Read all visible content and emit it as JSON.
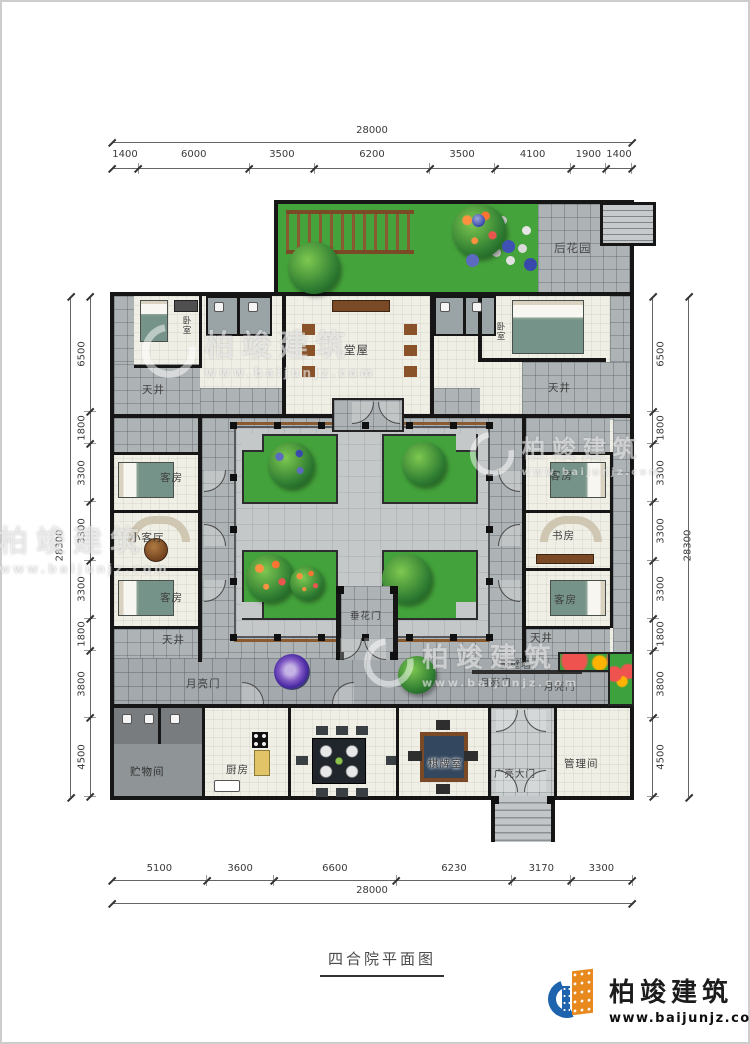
{
  "title_block": {
    "title": "四合院平面图"
  },
  "dimensions": {
    "top": {
      "total": "28000",
      "segments": [
        "1400",
        "6000",
        "3500",
        "6200",
        "3500",
        "4100",
        "1900",
        "1400"
      ]
    },
    "bottom": {
      "total": "28000",
      "segments": [
        "5100",
        "3600",
        "6600",
        "6230",
        "3170",
        "3300"
      ]
    },
    "left": {
      "total": "28300",
      "segments": [
        "6500",
        "1800",
        "3300",
        "3300",
        "3300",
        "1800",
        "3800",
        "4500"
      ]
    },
    "right": {
      "total": "28300",
      "segments": [
        "6500",
        "1800",
        "3300",
        "3300",
        "3300",
        "1800",
        "3800",
        "4500"
      ]
    }
  },
  "rooms": {
    "back_garden": "后花园",
    "hall": "堂屋",
    "bedroom": "卧室",
    "skywell": "天井",
    "guest_room": "客房",
    "small_living_room": "小客厅",
    "study": "书房",
    "festoon_gate": "垂花门",
    "moon_gate": "月亮门",
    "screen_wall": "影壁墙",
    "storage_room": "贮物间",
    "kitchen": "厨房",
    "chess_room": "棋牌室",
    "grand_gate": "广亮大门",
    "manager_room": "管理间"
  },
  "watermark": {
    "brand": "柏竣建筑",
    "url": "www.baijunjz.com"
  },
  "logo": {
    "brand": "柏竣建筑",
    "url": "www.baijunjz.com"
  },
  "colors": {
    "wall": "#161616",
    "garden_green": "#45a33c",
    "paving_gray": "#aeb3b6",
    "floor": "#f0efe6",
    "accent_brown": "#8a5a30",
    "logo_blue": "#1e63ad",
    "logo_orange": "#e8891d"
  }
}
